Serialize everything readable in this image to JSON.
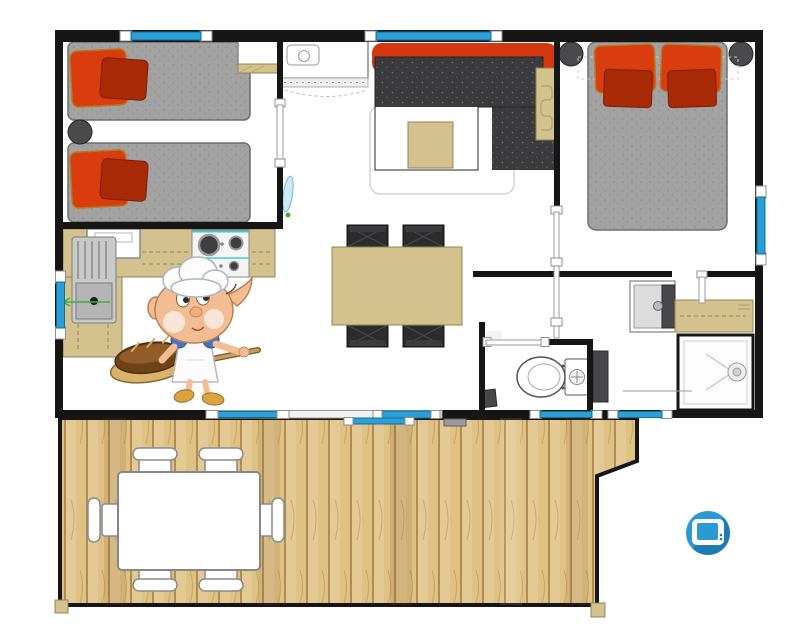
{
  "plan": {
    "type": "floor-plan",
    "rooms": [
      {
        "name": "bedroom-twin",
        "furniture": [
          "single-bed",
          "single-bed",
          "red-pillows",
          "round-nightstand",
          "wardrobe"
        ]
      },
      {
        "name": "kitchen",
        "furniture": [
          "sink-drainer",
          "hob-4-burners",
          "worktop",
          "appliance",
          "wall-heater"
        ]
      },
      {
        "name": "living-dining",
        "furniture": [
          "corner-sofa",
          "red-throw",
          "side-console",
          "coffee-table",
          "rug",
          "dining-table",
          "dining-chair",
          "dining-chair",
          "dining-chair",
          "dining-chair",
          "kitchenette-counter"
        ]
      },
      {
        "name": "bedroom-double",
        "furniture": [
          "double-bed",
          "red-pillows",
          "round-nightstand",
          "round-nightstand"
        ]
      },
      {
        "name": "bathroom",
        "furniture": [
          "washbasin",
          "vanity-counter",
          "shower",
          "storage-unit"
        ]
      },
      {
        "name": "wc",
        "furniture": [
          "toilet",
          "bin"
        ]
      },
      {
        "name": "terrace",
        "furniture": [
          "outdoor-table",
          "outdoor-chair",
          "outdoor-chair",
          "outdoor-chair",
          "outdoor-chair",
          "outdoor-chair",
          "outdoor-chair"
        ]
      }
    ],
    "windows": {
      "top_wall": 2,
      "left_wall": 1,
      "right_wall": 1,
      "bottom_wall": 4,
      "sliding_door_leaves": 2
    },
    "mascot": {
      "name": "baker-mascot",
      "props": [
        "chef-hat",
        "bread-loaf",
        "baker-peel",
        "apron"
      ]
    },
    "icons": [
      {
        "name": "tv-icon",
        "meaning": "TV available"
      }
    ]
  },
  "colors": {
    "wall": "#161616",
    "floor": "#ffffff",
    "window_blue": "#2d9fd6",
    "mattress": "#a2a2a2",
    "mattress_border": "#6e6e6e",
    "pillow_red": "#d93c0e",
    "pillow_dark": "#a82a07",
    "sofa_dark": "#3b3b3d",
    "sofa_red": "#d5370e",
    "tan": "#d3c28d",
    "tan_border": "#938455",
    "wood_base": "#dfc183",
    "wood_line": "#b08c52",
    "appliance_dark": "#48484a",
    "teal": "#46c8d8",
    "green": "#3fae3f",
    "icon_blue": "#2b99d4",
    "icon_blue_dark": "#1d7db3",
    "skin": "#f3bd93",
    "shirt_blue": "#4a72c4",
    "bread": "#6f4318",
    "peel": "#d9b36a",
    "shoe": "#d9a43f"
  }
}
